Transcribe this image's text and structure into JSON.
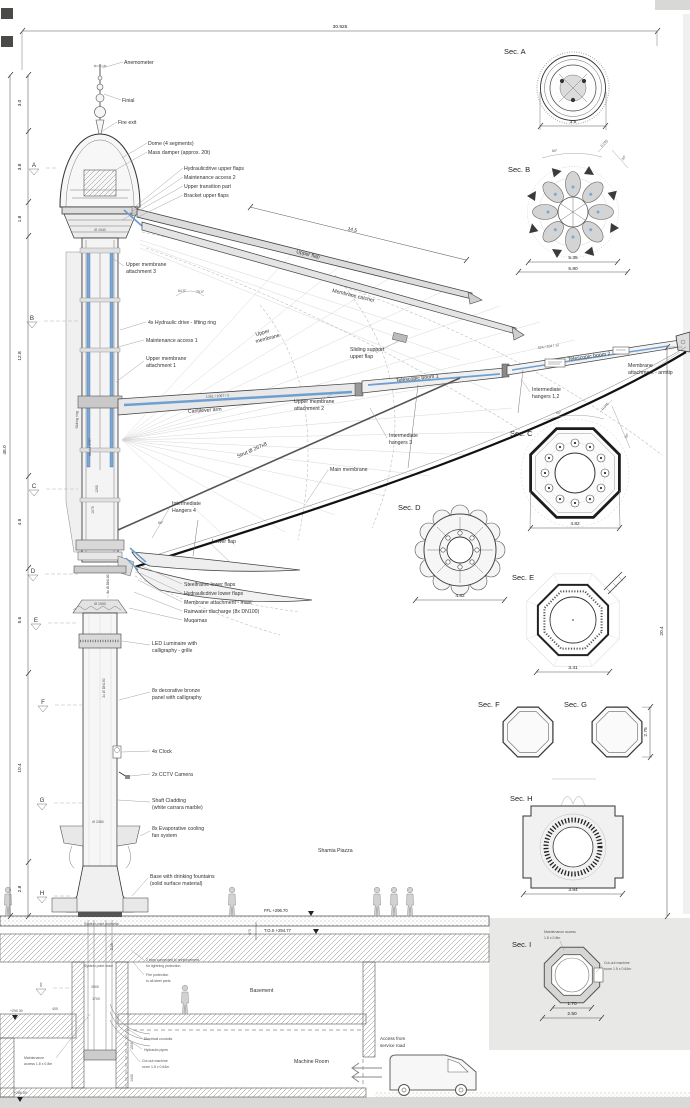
{
  "drawing": {
    "top_dim": "30.925",
    "left_total_dim": "45.0",
    "right_dim": "20.4",
    "flap_dim": "14.5",
    "left_segments": [
      "3.0",
      "3.8",
      "1.8",
      "12.8",
      "4.9",
      "5.6",
      "10.4",
      "2.8"
    ],
    "markers": [
      "A",
      "B",
      "C",
      "D",
      "E",
      "F",
      "G",
      "H",
      "I"
    ]
  },
  "mast": {
    "anemometer": "Anemometer",
    "finial": "Finial",
    "fire_exit": "Fire exit",
    "dome": "Dome (4 segments)",
    "mass_damper": "Mass damper (approx. 20t)",
    "hyd_upper_flaps": "Hydraulicdrive upper flaps",
    "maint2": "Maintenance access 2",
    "upper_transition": "Upper transition part",
    "bracket_upper_flaps": "Bracket upper flaps",
    "dia_1940": "Ø 1940",
    "um3a": "Upper membrane",
    "um3b": "attachment 3",
    "angle1": "64.5°",
    "angle2": "75.0°",
    "hyd_drive": "4x Hydraulic drive - lifting ring",
    "maint1": "Maintenance access 1",
    "um1a": "Upper membrane",
    "um1b": "attachment 1",
    "sliding_ring": "Sliding ring",
    "stroke_4797": "stroke 4797",
    "d1265": "1265",
    "d1075": "1075",
    "dn100": "8x Ø DN100",
    "dn150": "2x Ø DN150",
    "dia_1900": "Ø 1900",
    "dia_2380": "Ø 2380",
    "angle50": "50°",
    "hangers4a": "Intermediate",
    "hangers4b": "Hangers 4",
    "lower_flap": "Lower flap",
    "steelframe": "Steelframe lower flaps",
    "hyd_lower": "Hydraulicdrive lower flaps",
    "mem_mast": "Membrane attachment - mast",
    "rainwater": "Rainwater discharge (8x DN100)",
    "muqarnas": "Muqarnas",
    "led1": "LED Luminaire with",
    "led2": "calligraphy - grille",
    "bronze1": "8x decorative bronze",
    "bronze2": "panel with calligraphy",
    "clock": "4x Clock",
    "cctv": "2x CCTV Camera",
    "cladding1": "Shaft Cladding",
    "cladding2": "(white carrara marble)",
    "fans1": "8x Evaporative cooling",
    "fans2": "fan system",
    "base1": "Base with drinking fountains",
    "base2": "(solid surface material)",
    "piazza": "Shamia Piazza"
  },
  "boom": {
    "upper_flap": "Upper flap",
    "membrane_catcher": "Membrane catcher",
    "umem1": "Upper",
    "umem2": "membrane",
    "sliding1": "Sliding support",
    "sliding2": "upper flap",
    "boom1": "Telescopic boom 1",
    "boom2": "Telescopic boom 2",
    "code1": "1361 / 1067 / 5",
    "code2": "624 / 354 / 12",
    "armtip1": "Membrane",
    "armtip2": "attachment - armtip",
    "h12a": "Intermediate",
    "h12b": "hangers 1,2",
    "h3a": "Intermediate",
    "h3b": "hangers 3",
    "main_membrane": "Main membrane",
    "cantilever": "Cantilever arm",
    "um2a": "Upper membrane",
    "um2b": "attachment 2",
    "strut": "Strut Ø 267x8"
  },
  "sections": {
    "a": {
      "label": "Sec. A",
      "dim": "3.5"
    },
    "b": {
      "label": "Sec. B",
      "dim1": "5.35",
      "dim2": "5.80",
      "a60": "60°",
      "a30": "30°",
      "a245": "0.245"
    },
    "c": {
      "label": "Sec. C",
      "dim": "4.82",
      "a60": "60°",
      "a30": "30°",
      "a245": "0.245"
    },
    "d": {
      "label": "Sec. D",
      "dim": "4.82"
    },
    "e": {
      "label": "Sec. E",
      "dim": "3.41"
    },
    "f": {
      "label": "Sec. F"
    },
    "g": {
      "label": "Sec. G",
      "dim": "2.75"
    },
    "h": {
      "label": "Sec. H",
      "dim": "3.84"
    },
    "i": {
      "label": "Sec. I",
      "dim1": "1.70",
      "dim2": "2.50",
      "note1a": "Maintenance access",
      "note1b": "1.8 x 0.8m",
      "note2a": "Cut-out machine",
      "note2b": "room 1.5 x 0.64m"
    }
  },
  "ground": {
    "ffl": "FFL +296.70",
    "tos": "T.O.S +294.77",
    "d875": "875",
    "sys_umbrella": "System point umbrella",
    "sys_mast": "System point mast",
    "lightning1": "2 bars connected to reinforcement",
    "lightning2": "for lightning protection",
    "fire1": "Fire protection",
    "fire2": "to all steel parts",
    "basement": "Basement",
    "machine_room": "Machine Room",
    "access1": "Access from",
    "access2": "service road",
    "lvl_290": "+290.30",
    "lvl_286": "+286.00",
    "d2500": "2500",
    "d1700": "1700",
    "d400": "400",
    "d1500": "1500",
    "d1440": "1440",
    "d1135": "1135",
    "elec": "Electrical conduits",
    "hydpipes": "Hydraulic pipes",
    "cutout1": "Cut-out machine",
    "cutout2": "room 1.5 x 0.64m",
    "maint1": "Maintenance",
    "maint2": "access 1.8 x 0.8m"
  }
}
